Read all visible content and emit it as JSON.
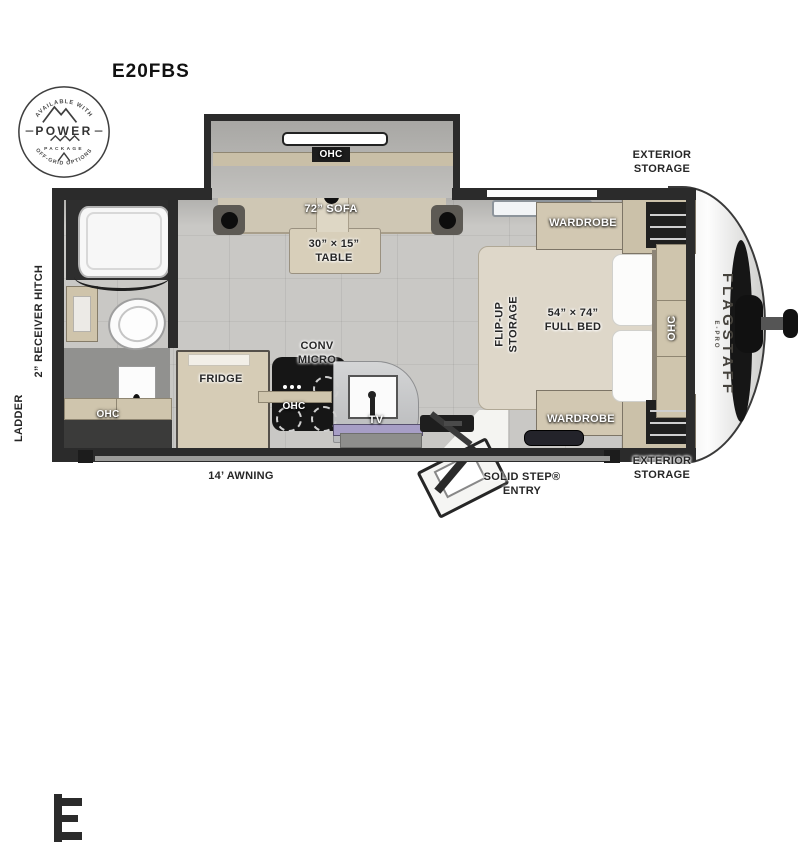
{
  "title": "E20FBS",
  "badge": {
    "top": "AVAILABLE WITH",
    "line1": "POWER",
    "line2": "PACKAGE",
    "bottom": "OFF-GRID OPTIONS"
  },
  "labels": {
    "exterior_storage_top": "EXTERIOR STORAGE",
    "exterior_storage_bottom": "EXTERIOR STORAGE",
    "receiver_hitch": "2” RECEIVER HITCH",
    "ladder": "LADDER",
    "awning": "14’ AWNING",
    "solid_step": "SOLID STEP® ENTRY",
    "brand": "FLAGSTAFF",
    "brand_sub": "E-PRO",
    "slide_ohc": "OHC",
    "sofa": "72” SOFA",
    "table": "30” × 15” TABLE",
    "flip_up": "FLIP-UP STORAGE",
    "bed": "54” × 74” FULL BED",
    "wardrobe_top": "WARDROBE",
    "wardrobe_bottom": "WARDROBE",
    "bed_ohc": "OHC",
    "conv_micro": "CONV MICRO",
    "fridge": "FRIDGE",
    "kitchen_ohc": "OHC",
    "tv": "TV",
    "bath_ohc": "OHC"
  },
  "colors": {
    "wall": "#2b2b2b",
    "floor": "#c9c8c5",
    "wood": "#d2c8b2",
    "cap_trim": "#161616",
    "sink_glass": "#a79ec6"
  }
}
